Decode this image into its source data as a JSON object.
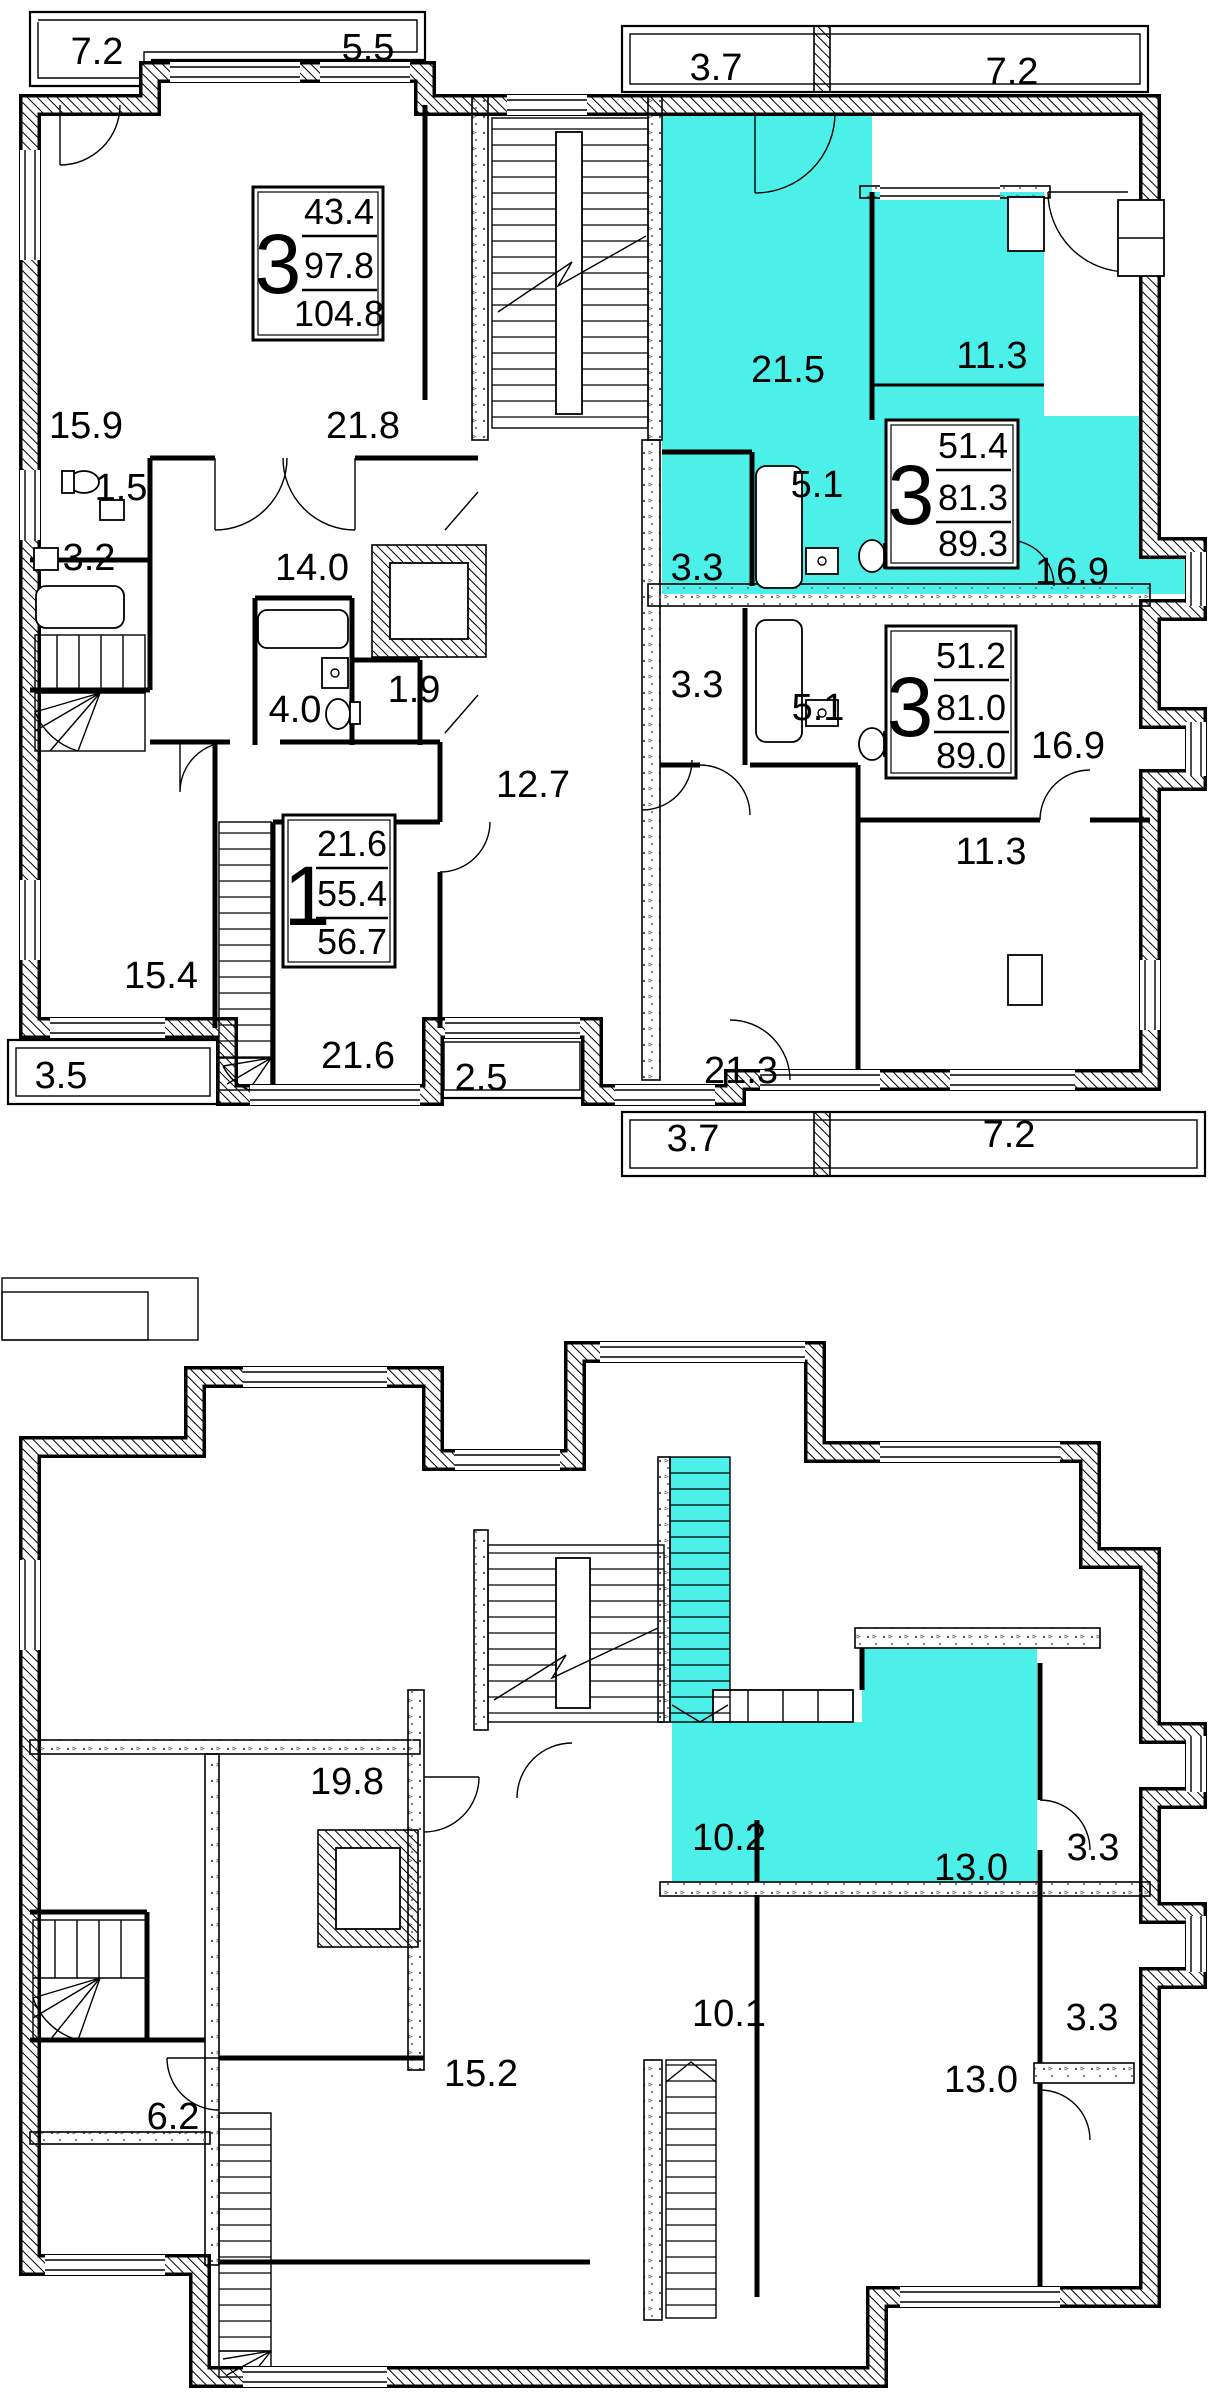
{
  "colors": {
    "highlight": "#4DF0E9",
    "line": "#000000",
    "background": "#FFFFFF"
  },
  "upper_floor": {
    "balconies": {
      "top_left": "7.2",
      "top_center": "5.5",
      "top_right_a": "3.7",
      "top_right_b": "7.2",
      "bottom_left": "3.5",
      "bottom_center": "2.5",
      "bottom_right_a": "3.7",
      "bottom_right_b": "7.2"
    },
    "rooms": {
      "living_21_5": "21.5",
      "bedroom_11_3": "11.3",
      "room_15_9": "15.9",
      "room_21_8": "21.8",
      "wc_1_5": "1.5",
      "bath_3_2": "3.2",
      "hall_14_0": "14.0",
      "bath_4_0": "4.0",
      "storage_1_9": "1.9",
      "hl_hall_3_3": "3.3",
      "hl_corridor_5_1": "5.1",
      "hl_kitchen_16_9": "16.9",
      "apt3_hall_3_3": "3.3",
      "apt3_corridor_5_1": "5.1",
      "apt3_kitchen_16_9": "16.9",
      "apt3_bedroom_11_3": "11.3",
      "corridor_12_7": "12.7",
      "room_15_4": "15.4",
      "room_21_6": "21.6",
      "room_21_3": "21.3"
    },
    "apartments": [
      {
        "rooms": "3",
        "living": "43.4",
        "usable": "97.8",
        "total": "104.8"
      },
      {
        "rooms": "3",
        "living": "51.4",
        "usable": "81.3",
        "total": "89.3"
      },
      {
        "rooms": "3",
        "living": "51.2",
        "usable": "81.0",
        "total": "89.0"
      },
      {
        "rooms": "1",
        "living": "21.6",
        "usable": "55.4",
        "total": "56.7"
      }
    ]
  },
  "lower_floor": {
    "rooms": {
      "room_19_8": "19.8",
      "hl_room_10_2": "10.2",
      "hl_room_13_0": "13.0",
      "loggia_3_3_top": "3.3",
      "room_10_1": "10.1",
      "room_13_0": "13.0",
      "loggia_3_3_bottom": "3.3",
      "room_6_2": "6.2",
      "room_15_2": "15.2"
    }
  }
}
